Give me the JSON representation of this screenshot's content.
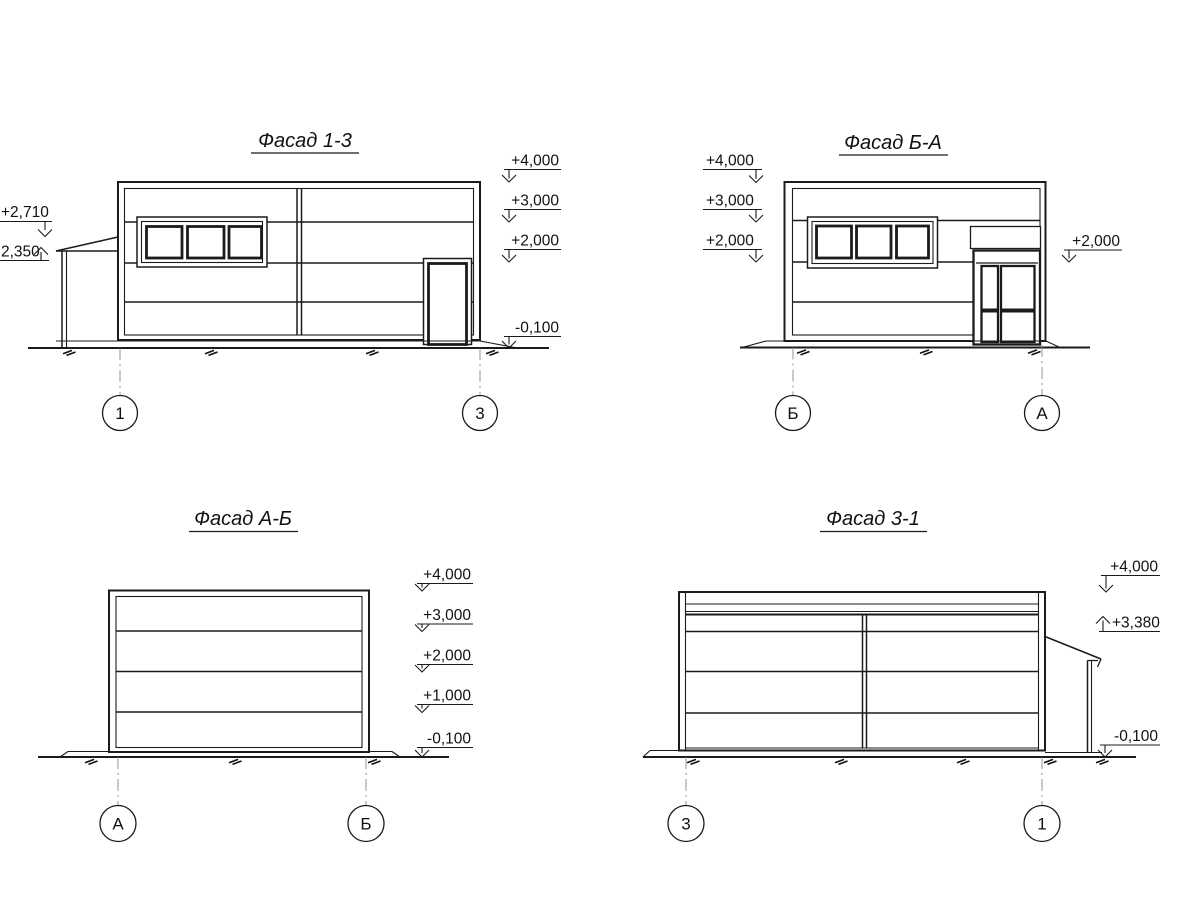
{
  "colors": {
    "ink": "#1b1b1b",
    "axis_line": "#8a8a8a",
    "background": "#ffffff"
  },
  "facades": {
    "f13": {
      "title": "Фасад 1-3",
      "axes": {
        "left": "1",
        "right": "3"
      },
      "marks_right": {
        "m4000": "+4,000",
        "m3000": "+3,000",
        "m2000": "+2,000",
        "mneg": "-0,100"
      },
      "marks_left": {
        "m2710": "+2,710",
        "m2350": "2,350"
      }
    },
    "fba": {
      "title": "Фасад Б-А",
      "axes": {
        "left": "Б",
        "right": "А"
      },
      "marks_left": {
        "m4000": "+4,000",
        "m3000": "+3,000",
        "m2000": "+2,000"
      },
      "marks_right": {
        "m2000": "+2,000"
      }
    },
    "fab": {
      "title": "Фасад А-Б",
      "axes": {
        "left": "А",
        "right": "Б"
      },
      "marks_right": {
        "m4000": "+4,000",
        "m3000": "+3,000",
        "m2000": "+2,000",
        "m1000": "+1,000",
        "mneg": "-0,100"
      }
    },
    "f31": {
      "title": "Фасад 3-1",
      "axes": {
        "left": "3",
        "right": "1"
      },
      "marks_right": {
        "m4000": "+4,000",
        "m3380": "+3,380",
        "mneg": "-0,100"
      }
    }
  }
}
